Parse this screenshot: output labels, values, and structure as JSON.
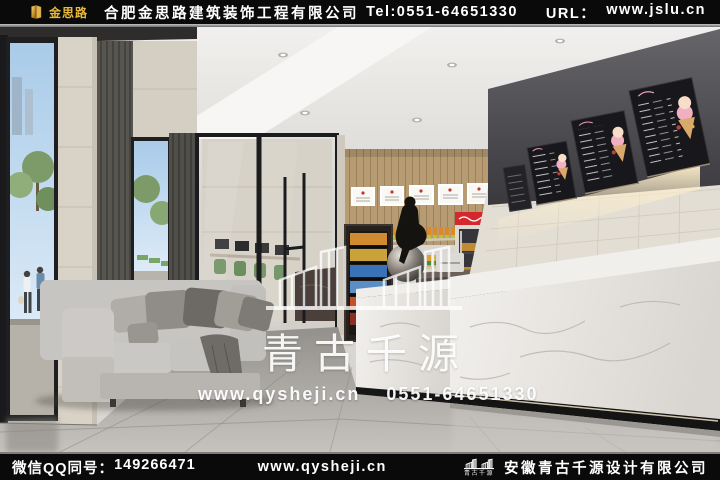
{
  "header": {
    "brand": "金思路",
    "company": "合肥金思路建筑装饰工程有限公司",
    "tel": "Tel:0551-64651330",
    "url_label": "URL：",
    "url": "www.jslu.cn"
  },
  "watermark": {
    "brand": "青古千源",
    "website": "www.qysheji.cn",
    "phone": "0551-64651330"
  },
  "footer": {
    "wechat_qq_label": "微信QQ同号：",
    "wechat_qq_number": "149266471",
    "website": "www.qysheji.cn",
    "logo_caption": "青古千源",
    "company": "安徽青古千源设计有限公司"
  },
  "colors": {
    "brand_gold": "#e8b93c",
    "bar_background": "#0a0a0a",
    "cola_red": "#d5282d",
    "watermark_white": "#ffffff"
  }
}
